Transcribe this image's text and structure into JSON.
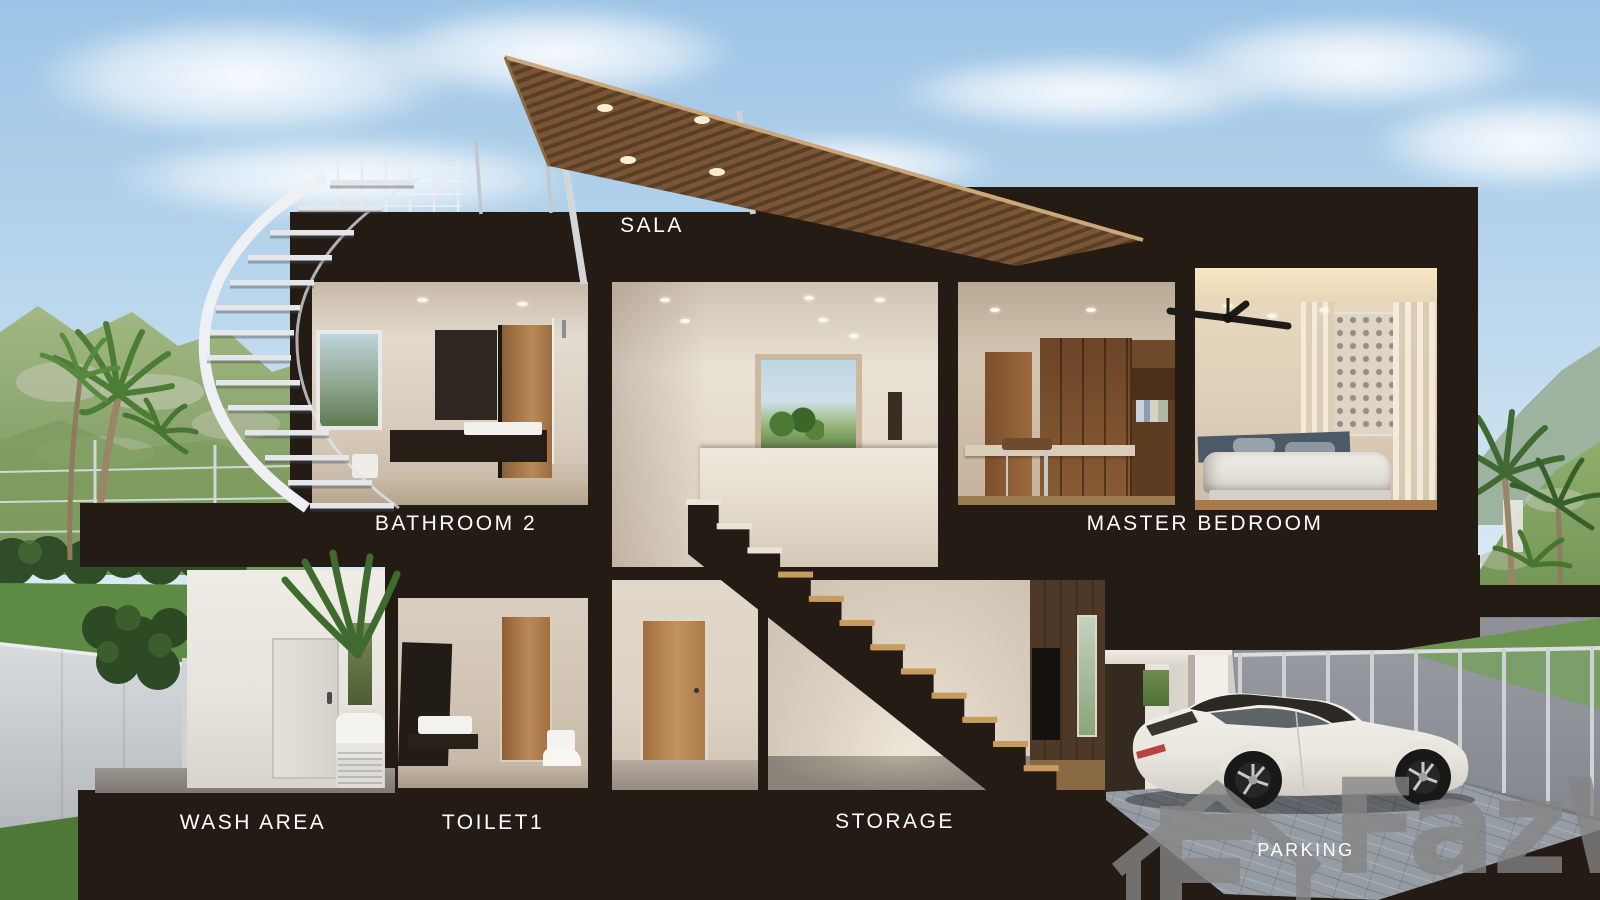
{
  "scene": {
    "description": "Cross-section 3D rendering of a two-storey villa with labelled rooms",
    "setting": "tropical hillside with palm trees and mountains"
  },
  "rooms": [
    {
      "id": "sala",
      "label": "SALA"
    },
    {
      "id": "bathroom-2",
      "label": "BATHROOM 2"
    },
    {
      "id": "master-bedroom",
      "label": "MASTER BEDROOM"
    },
    {
      "id": "wash-area",
      "label": "WASH AREA"
    },
    {
      "id": "toilet-1",
      "label": "TOILET1"
    },
    {
      "id": "storage",
      "label": "STORAGE"
    },
    {
      "id": "parking",
      "label": "PARKING"
    }
  ],
  "objects": [
    "wooden slat roof canopy",
    "spiral staircase",
    "main staircase",
    "white sports car",
    "ceiling fan",
    "double bed",
    "washing machine",
    "toilet",
    "wardrobe"
  ],
  "watermark": {
    "brand": "FazWaz"
  },
  "colors": {
    "structure_dark": "#241b14",
    "sky_top": "#9cc4e6",
    "roof_wood": "#7a5636",
    "label_text": "#ffffff",
    "watermark_gray": "#868686"
  }
}
